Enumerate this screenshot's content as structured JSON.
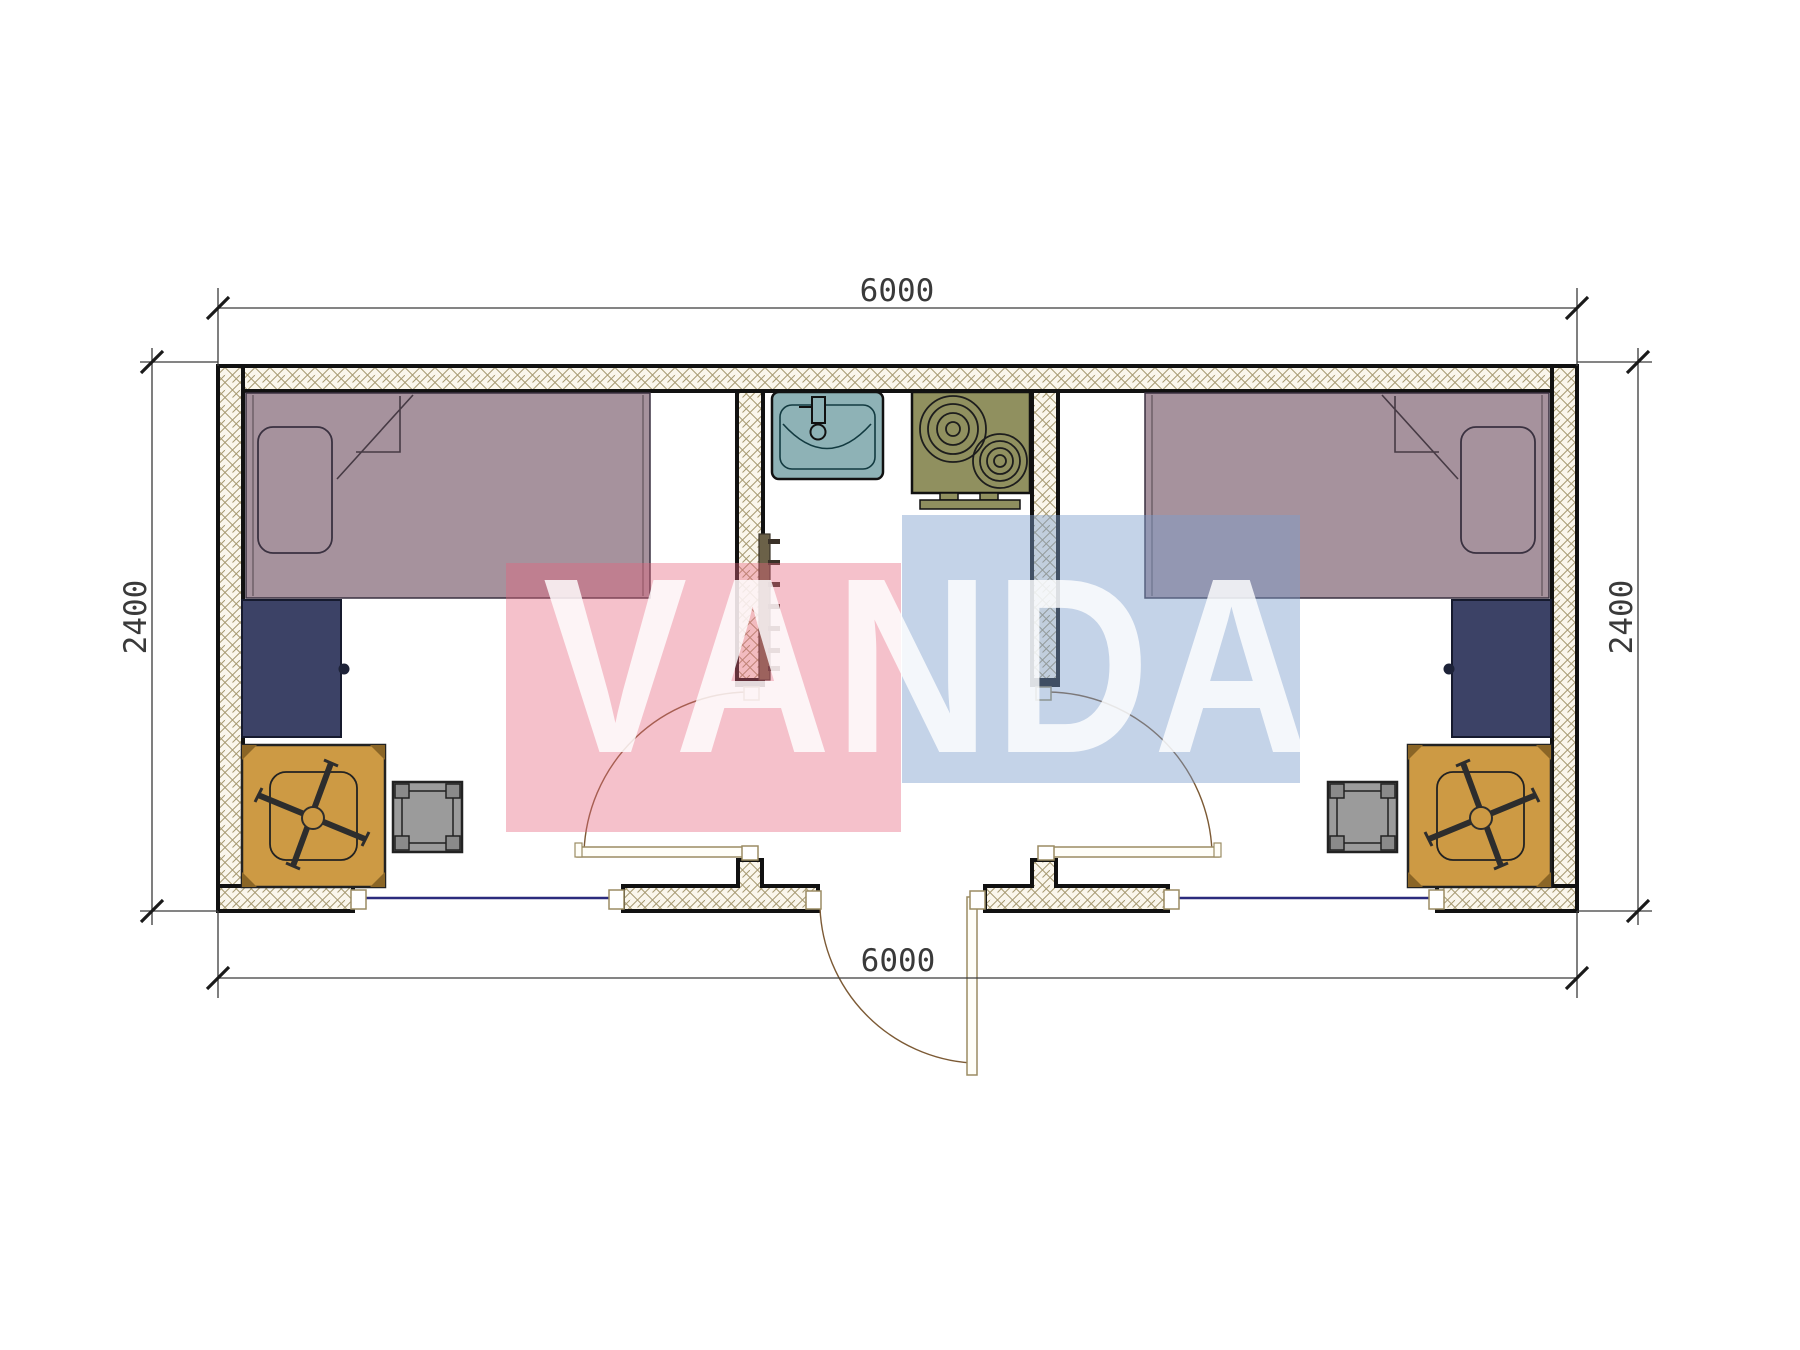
{
  "drawing": {
    "type": "floor-plan",
    "description": "Container house plan, two bedrooms with central kitchen/bath",
    "unit": "mm"
  },
  "dimensions": {
    "top_width": "6000",
    "bottom_width": "6000",
    "left_height": "2400",
    "right_height": "2400"
  },
  "watermark": {
    "text": "VANDA"
  },
  "colors": {
    "bed": "#a6929d",
    "pillow_outline": "#3a3140",
    "cabinet": "#3c4266",
    "cabinet_knob": "#1d2238",
    "table": "#cd9a44",
    "stool": "#9b9b9b",
    "stool_leg": "#8a8a8a",
    "sink": "#8eb2b6",
    "stove": "#90905f",
    "towel_rail": "#6b6148",
    "towel_rung": "#3a3128",
    "wall_fill": "#faf6ec",
    "wall_hatch_line": "#a79a72",
    "wall_outline": "#111111",
    "window_glass": "#2b2b7d",
    "door_frame": "#9b8c63",
    "door_arc": "#7c5a35",
    "dim_line": "#3a3a3a",
    "pink_block": "rgba(230,100,125,0.40)",
    "blue_block": "rgba(125,158,205,0.45)",
    "watermark_text": "#ffffff"
  }
}
